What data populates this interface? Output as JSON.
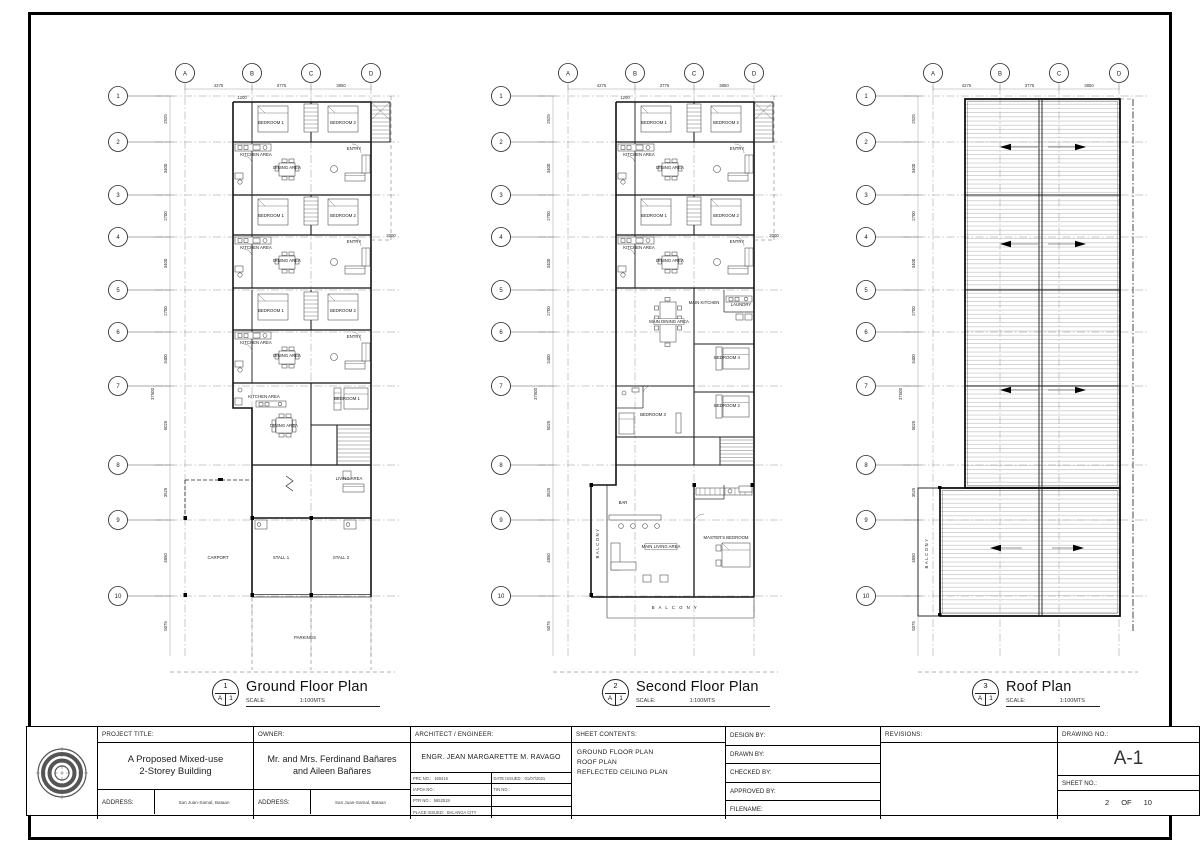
{
  "sheet": {
    "project_title_label": "PROJECT TITLE:",
    "project_title_line1": "A Proposed Mixed-use",
    "project_title_line2": "2-Storey Building",
    "owner_label": "OWNER:",
    "owner_line1": "Mr. and Mrs. Ferdinand Bañares",
    "owner_line2": "and Aileen Bañares",
    "address_label": "ADDRESS:",
    "project_address": "San Juan-Samal, Bataan",
    "owner_address": "San Juan-Samal, Bataan",
    "architect_label": "ARCHITECT / ENGINEER:",
    "architect_name": "ENGR. JEAN MARGARETTE M. RAVAGO",
    "prc_label": "PRC NO.:",
    "prc_no": "160416",
    "date_issued_label": "DATE ISSUED:",
    "date_issued": "01/07/2021",
    "iapoa_label": "IAPOA NO.:",
    "iapoa_no": "",
    "tin_label": "TIN NO.:",
    "tin_no": "",
    "ptr_label": "PTR NO.:",
    "ptr_no": "5652519",
    "place_issued_label": "PLACE ISSUED:",
    "place_issued": "BALANGA CITY",
    "sheet_contents_label": "SHEET CONTENTS:",
    "sheet_contents": [
      "GROUND FLOOR PLAN",
      "ROOF PLAN",
      "REFLECTED CEILING PLAN"
    ],
    "design_by_label": "DESIGN BY:",
    "drawn_by_label": "DRAWN BY:",
    "checked_by_label": "CHECKED BY:",
    "approved_by_label": "APPROVED BY:",
    "filename_label": "FILENAME:",
    "revisions_label": "REVISIONS:",
    "drawing_no_label": "DRAWING NO.:",
    "drawing_no": "A-1",
    "sheet_no_label": "SHEET NO.:",
    "sheet_no_value": "2",
    "sheet_no_of": "OF",
    "sheet_no_total": "10"
  },
  "plans": [
    {
      "number": "1",
      "ref_letter": "A",
      "ref_num": "1",
      "title": "Ground Floor Plan",
      "scale_label": "SCALE:",
      "scale_value": "1:100MTS",
      "grid_cols": [
        "A",
        "B",
        "C",
        "D"
      ],
      "grid_rows": [
        "1",
        "2",
        "3",
        "4",
        "5",
        "6",
        "7",
        "8",
        "9",
        "10"
      ],
      "grid_x": [
        85,
        152,
        211,
        271
      ],
      "grid_y": [
        40,
        86,
        139,
        181,
        234,
        276,
        330,
        409,
        464,
        540
      ],
      "grid_bottom": 600,
      "dims_top": [
        "4275",
        "3775",
        "3850"
      ],
      "dims_left": [
        "2925",
        "3400",
        "2700",
        "3400",
        "2700",
        "3400",
        "5025",
        "3525",
        "4850",
        "5075"
      ],
      "dim_overall": "37500",
      "extra_dims": [
        {
          "label": "1200",
          "x": 142,
          "y": 43
        },
        {
          "label": "2000",
          "x": 291,
          "y": 181
        }
      ],
      "rooms": [
        {
          "label": "BEDROOM 1",
          "x": 171,
          "y": 68
        },
        {
          "label": "BEDROOM 2",
          "x": 243,
          "y": 68
        },
        {
          "label": "KITCHEN AREA",
          "x": 156,
          "y": 100,
          "fs": 3.6
        },
        {
          "label": "DINING AREA",
          "x": 187,
          "y": 113,
          "fs": 3.4
        },
        {
          "label": "ENTRY",
          "x": 254,
          "y": 94,
          "fs": 3.4
        },
        {
          "label": "BEDROOM 1",
          "x": 171,
          "y": 161
        },
        {
          "label": "BEDROOM 2",
          "x": 243,
          "y": 161
        },
        {
          "label": "KITCHEN AREA",
          "x": 156,
          "y": 193,
          "fs": 3.6
        },
        {
          "label": "DINING AREA",
          "x": 187,
          "y": 206,
          "fs": 3.4
        },
        {
          "label": "ENTRY",
          "x": 254,
          "y": 187,
          "fs": 3.4
        },
        {
          "label": "BEDROOM 1",
          "x": 171,
          "y": 256
        },
        {
          "label": "BEDROOM 2",
          "x": 243,
          "y": 256
        },
        {
          "label": "KITCHEN AREA",
          "x": 156,
          "y": 288,
          "fs": 3.6
        },
        {
          "label": "DINING AREA",
          "x": 187,
          "y": 301,
          "fs": 3.4
        },
        {
          "label": "ENTRY",
          "x": 254,
          "y": 282,
          "fs": 3.4
        },
        {
          "label": "KITCHEN AREA",
          "x": 164,
          "y": 342,
          "fs": 3.6
        },
        {
          "label": "DINING AREA",
          "x": 184,
          "y": 371,
          "fs": 3.6
        },
        {
          "label": "BEDROOM 1",
          "x": 247,
          "y": 344
        },
        {
          "label": "LIVING AREA",
          "x": 249,
          "y": 424,
          "fs": 3.6
        },
        {
          "label": "CARPORT",
          "x": 118,
          "y": 503
        },
        {
          "label": "STALL 1",
          "x": 181,
          "y": 503
        },
        {
          "label": "STALL 2",
          "x": 241,
          "y": 503
        },
        {
          "label": "PARKINGS",
          "x": 205,
          "y": 583
        }
      ]
    },
    {
      "number": "2",
      "ref_letter": "A",
      "ref_num": "1",
      "title": "Second Floor Plan",
      "scale_label": "SCALE:",
      "scale_value": "1:100MTS",
      "grid_cols": [
        "A",
        "B",
        "C",
        "D"
      ],
      "grid_rows": [
        "1",
        "2",
        "3",
        "4",
        "5",
        "6",
        "7",
        "8",
        "9",
        "10"
      ],
      "grid_x": [
        85,
        152,
        211,
        271
      ],
      "grid_y": [
        40,
        86,
        139,
        181,
        234,
        276,
        330,
        409,
        464,
        540
      ],
      "grid_bottom": 600,
      "dims_top": [
        "4275",
        "3775",
        "3850"
      ],
      "dims_left": [
        "2925",
        "3400",
        "2700",
        "3400",
        "2700",
        "3400",
        "5025",
        "3525",
        "4850",
        "5075"
      ],
      "dim_overall": "37500",
      "extra_dims": [
        {
          "label": "1200",
          "x": 142,
          "y": 43
        },
        {
          "label": "2000",
          "x": 291,
          "y": 181
        }
      ],
      "rooms": [
        {
          "label": "BEDROOM 1",
          "x": 171,
          "y": 68
        },
        {
          "label": "BEDROOM 2",
          "x": 243,
          "y": 68
        },
        {
          "label": "KITCHEN AREA",
          "x": 156,
          "y": 100,
          "fs": 3.6
        },
        {
          "label": "DINING AREA",
          "x": 187,
          "y": 113,
          "fs": 3.4
        },
        {
          "label": "ENTRY",
          "x": 254,
          "y": 94,
          "fs": 3.4
        },
        {
          "label": "BEDROOM 1",
          "x": 171,
          "y": 161
        },
        {
          "label": "BEDROOM 2",
          "x": 243,
          "y": 161
        },
        {
          "label": "KITCHEN AREA",
          "x": 156,
          "y": 193,
          "fs": 3.6
        },
        {
          "label": "DINING AREA",
          "x": 187,
          "y": 206,
          "fs": 3.4
        },
        {
          "label": "ENTRY",
          "x": 254,
          "y": 187,
          "fs": 3.4
        },
        {
          "label": "MAIN KITCHEN",
          "x": 221,
          "y": 248,
          "fs": 3.6
        },
        {
          "label": "LAUNDRY",
          "x": 258,
          "y": 250,
          "fs": 3.4
        },
        {
          "label": "MAIN DINING AREA",
          "x": 186,
          "y": 267,
          "fs": 3.2,
          "box": 30
        },
        {
          "label": "BEDROOM 4",
          "x": 244,
          "y": 303
        },
        {
          "label": "BEDROOM 3",
          "x": 170,
          "y": 360
        },
        {
          "label": "BEDROOM 2",
          "x": 244,
          "y": 351
        },
        {
          "label": "BAR",
          "x": 140,
          "y": 448,
          "fs": 3.8
        },
        {
          "label": "MAIN LIVING AREA",
          "x": 178,
          "y": 492,
          "fs": 3.2,
          "box": 32
        },
        {
          "label": "MASTER'S BEDROOM",
          "x": 243,
          "y": 483,
          "fs": 3.3
        },
        {
          "label": "BALCONY",
          "x": 116,
          "y": 487,
          "rot": -90,
          "ls": 1.5,
          "fs": 3.6
        },
        {
          "label": "B A L C O N Y",
          "x": 192,
          "y": 553,
          "ls": 1.5,
          "fs": 4
        }
      ]
    },
    {
      "number": "3",
      "ref_letter": "A",
      "ref_num": "1",
      "title": "Roof Plan",
      "scale_label": "SCALE:",
      "scale_value": "1:100MTS",
      "grid_cols": [
        "A",
        "B",
        "C",
        "D"
      ],
      "grid_rows": [
        "1",
        "2",
        "3",
        "4",
        "5",
        "6",
        "7",
        "8",
        "9",
        "10"
      ],
      "grid_x": [
        85,
        152,
        211,
        271
      ],
      "grid_y": [
        40,
        86,
        139,
        181,
        234,
        276,
        330,
        409,
        464,
        540
      ],
      "grid_bottom": 600,
      "dims_top": [
        "4275",
        "3775",
        "3850"
      ],
      "dims_left": [
        "2925",
        "3400",
        "2700",
        "3400",
        "2700",
        "3400",
        "5025",
        "3525",
        "4850",
        "5075"
      ],
      "dim_overall": "37500",
      "extra_dims": [],
      "rooms": [
        {
          "label": "BALCONY",
          "x": 80,
          "y": 497,
          "rot": -90,
          "ls": 1.5,
          "fs": 3.6
        }
      ]
    }
  ]
}
